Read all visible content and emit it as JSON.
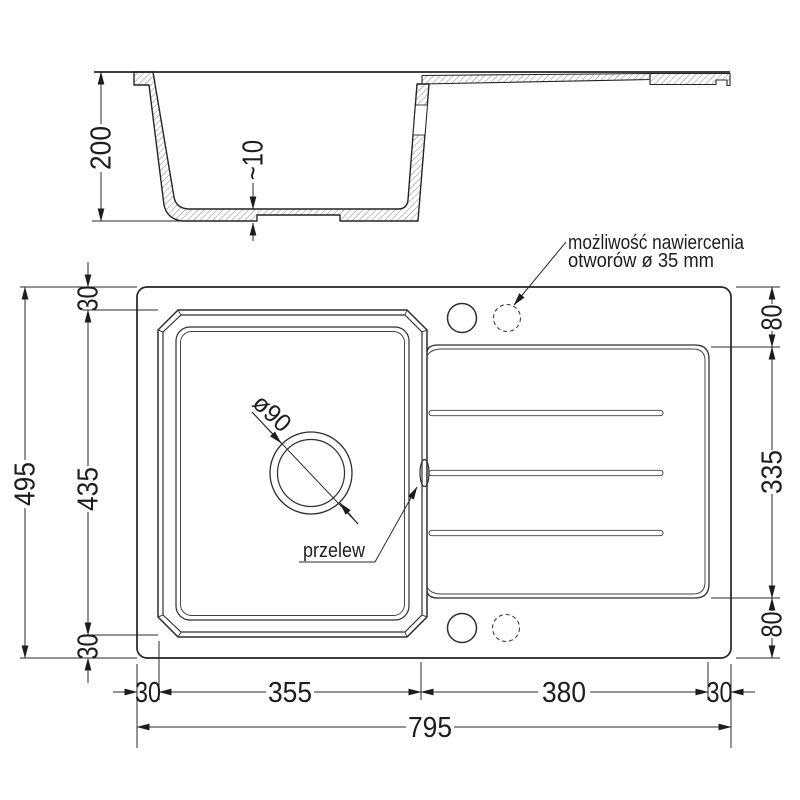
{
  "dims": {
    "depth": "200",
    "bottom_thickness": "~10",
    "total_height": "495",
    "bowl_opening_height": "435",
    "rim_top": "30",
    "rim_bottom": "30",
    "rim_left": "30",
    "rim_right": "30",
    "bowl_opening_width": "355",
    "drainer_width": "380",
    "total_width": "795",
    "deck_top": "80",
    "drainer_height": "335",
    "deck_bottom": "80",
    "drain_diameter": "ø90"
  },
  "labels": {
    "drill_note_line1": "możliwość nawiercenia",
    "drill_note_line2": "otworów ø 35 mm",
    "overflow": "przelew"
  },
  "colors": {
    "line": "#242424",
    "thin_line": "#3f3f3f",
    "background": "#ffffff"
  }
}
